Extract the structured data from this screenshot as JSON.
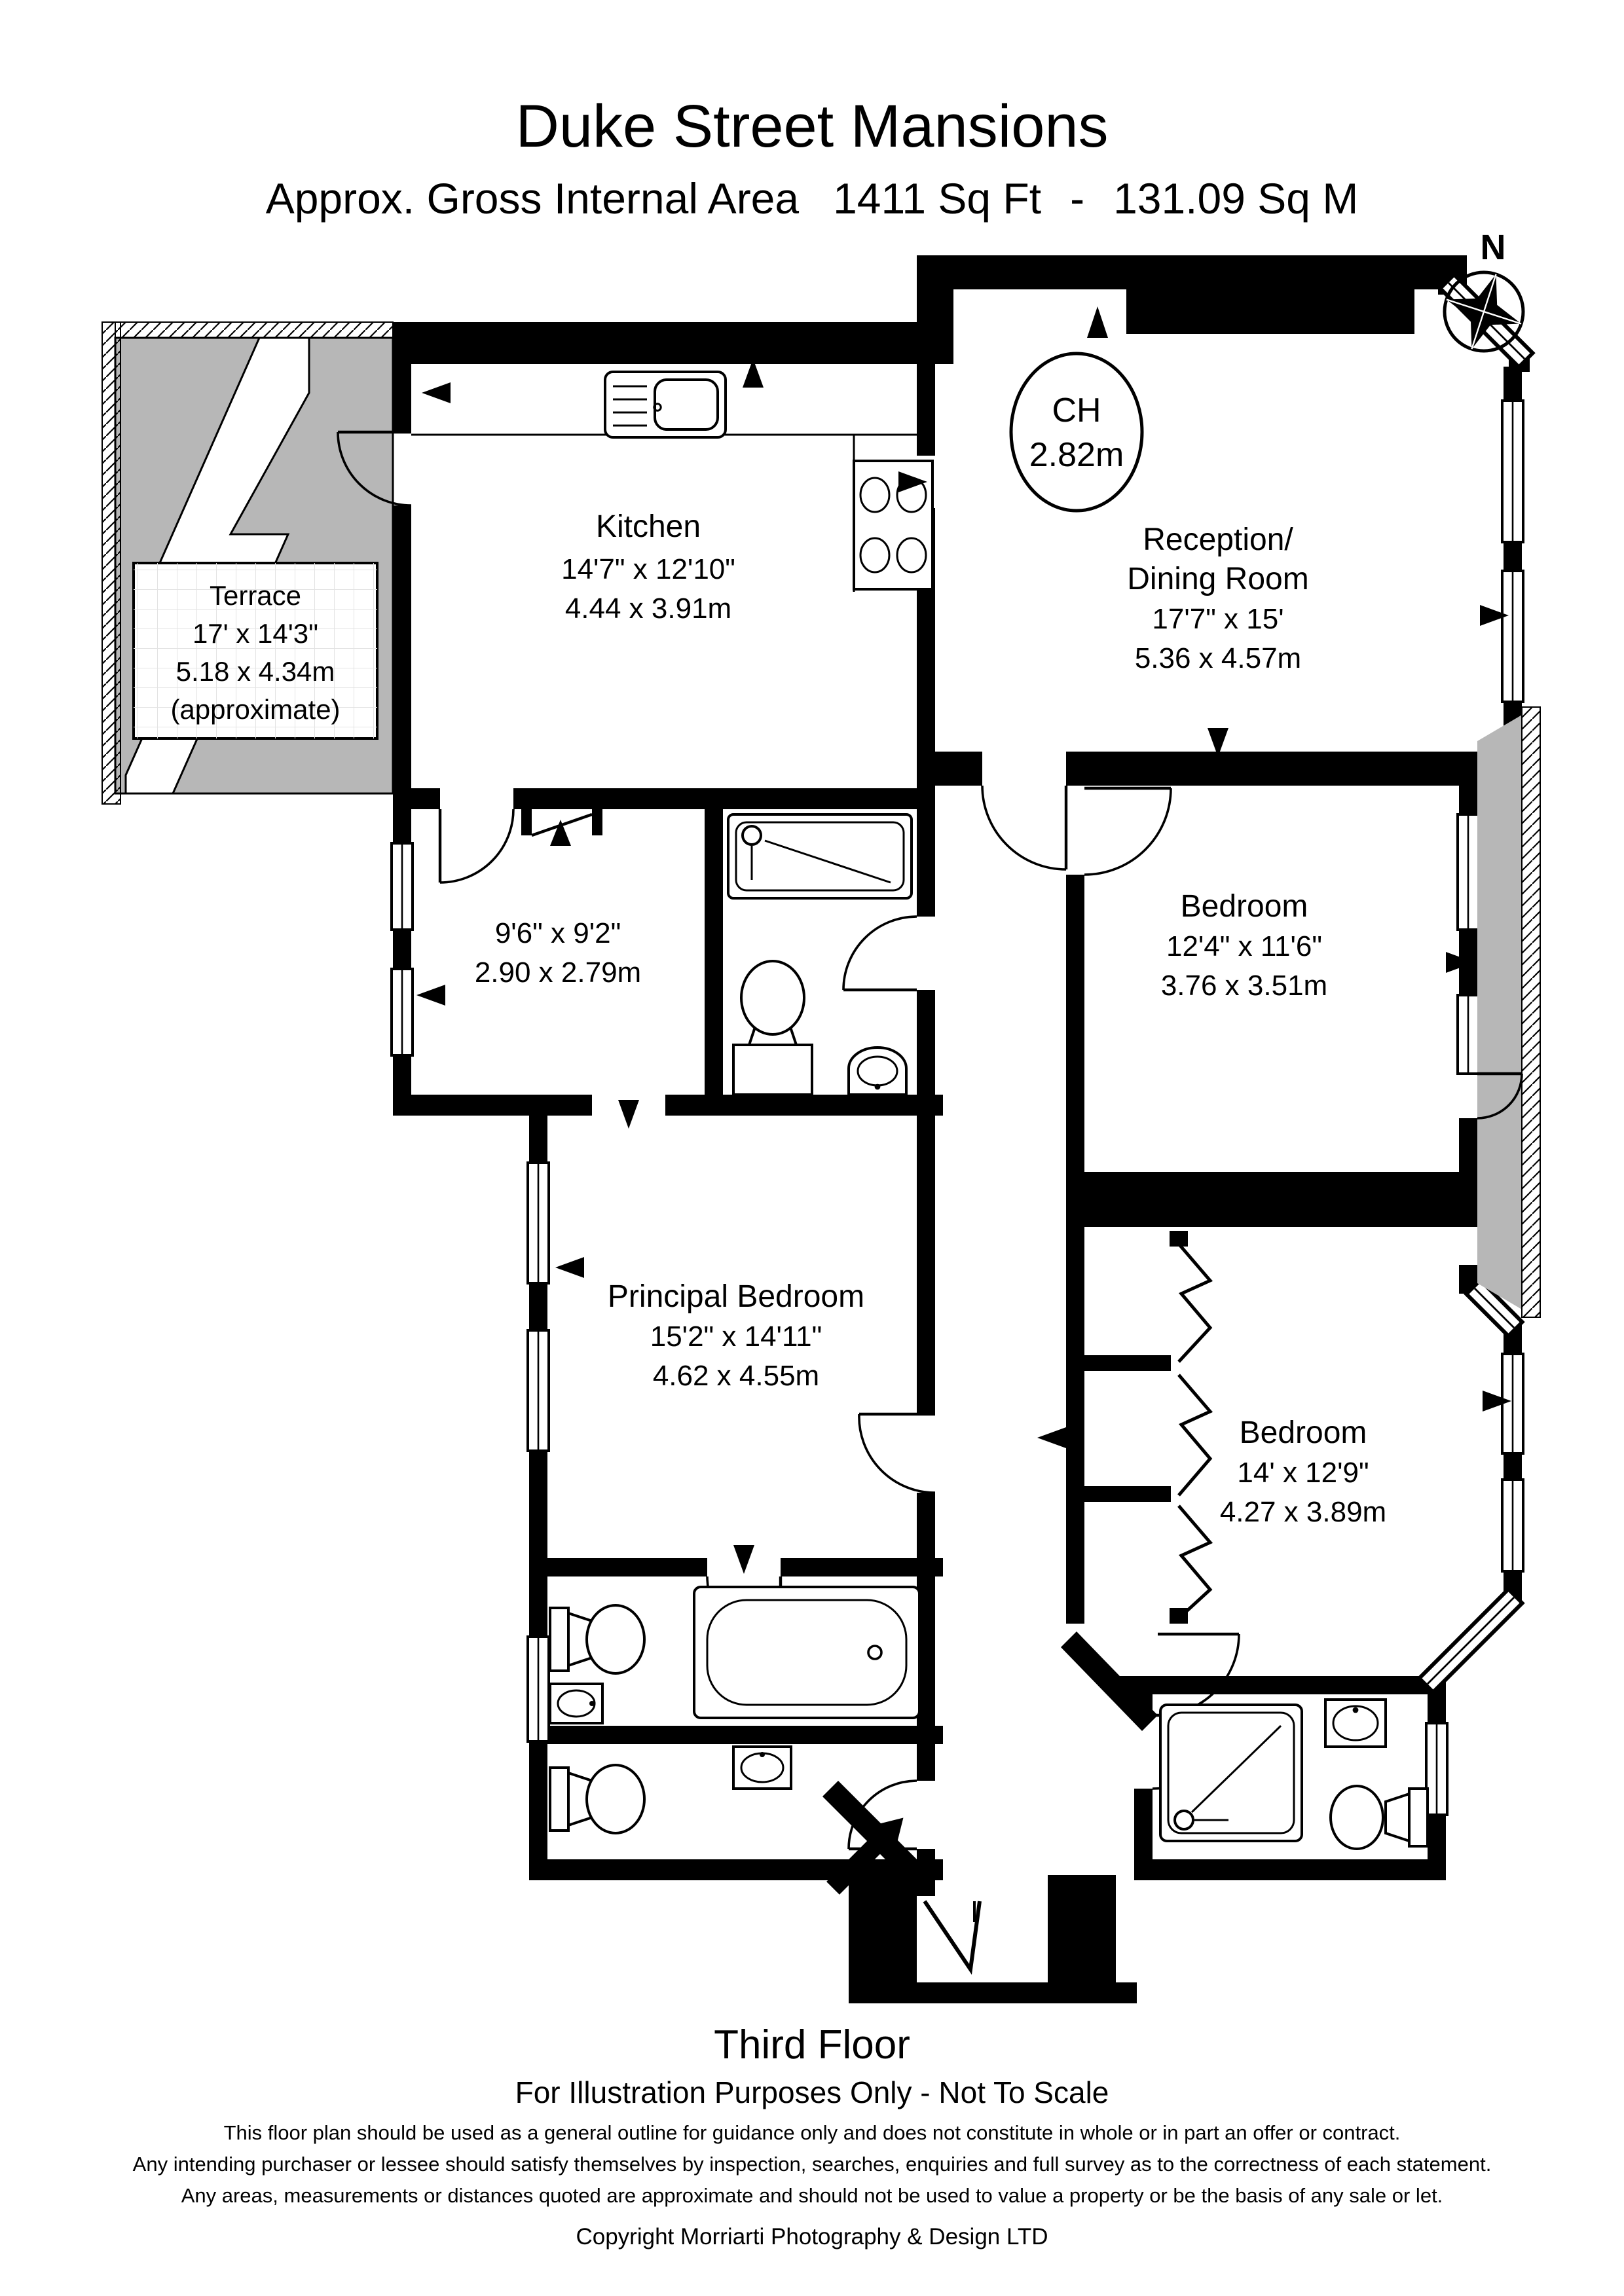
{
  "header": {
    "title": "Duke Street Mansions",
    "area_label": "Approx. Gross Internal Area",
    "area_sqft": "1411 Sq Ft",
    "dash": "-",
    "area_sqm": "131.09 Sq M"
  },
  "compass": {
    "north_label": "N"
  },
  "rooms": {
    "terrace": {
      "name": "Terrace",
      "imperial": "17' x 14'3\"",
      "metric": "5.18 x 4.34m",
      "note": "(approximate)"
    },
    "kitchen": {
      "name": "Kitchen",
      "imperial": "14'7\" x 12'10\"",
      "metric": "4.44 x 3.91m"
    },
    "reception": {
      "name_line1": "Reception/",
      "name_line2": "Dining Room",
      "imperial": "17'7\" x 15'",
      "metric": "5.36 x 4.57m"
    },
    "ceiling_height": {
      "label": "CH",
      "value": "2.82m"
    },
    "inner_room": {
      "imperial": "9'6\" x 9'2\"",
      "metric": "2.90 x 2.79m"
    },
    "bedroom1": {
      "name": "Bedroom",
      "imperial": "12'4\" x 11'6\"",
      "metric": "3.76 x 3.51m"
    },
    "principal_bedroom": {
      "name": "Principal Bedroom",
      "imperial": "15'2\" x 14'11\"",
      "metric": "4.62 x 4.55m"
    },
    "bedroom2": {
      "name": "Bedroom",
      "imperial": "14' x 12'9\"",
      "metric": "4.27 x 3.89m"
    }
  },
  "footer": {
    "floor": "Third Floor",
    "scale_note": "For Illustration Purposes Only - Not To Scale",
    "disclaimer_line1": "This floor plan should be used as a general outline for guidance only and does not constitute in whole or in part an offer or contract.",
    "disclaimer_line2": "Any intending purchaser or lessee should satisfy themselves by inspection, searches, enquiries and full survey as to the correctness of each statement.",
    "disclaimer_line3": "Any areas, measurements or distances quoted are approximate and should not be used to value a property or be the basis of any sale or let.",
    "copyright": "Copyright Morriarti Photography & Design LTD"
  },
  "colors": {
    "wall": "#000000",
    "terrace_fill": "#b7b7b7",
    "lightwell_fill": "#b7b7b7",
    "background": "#ffffff"
  }
}
